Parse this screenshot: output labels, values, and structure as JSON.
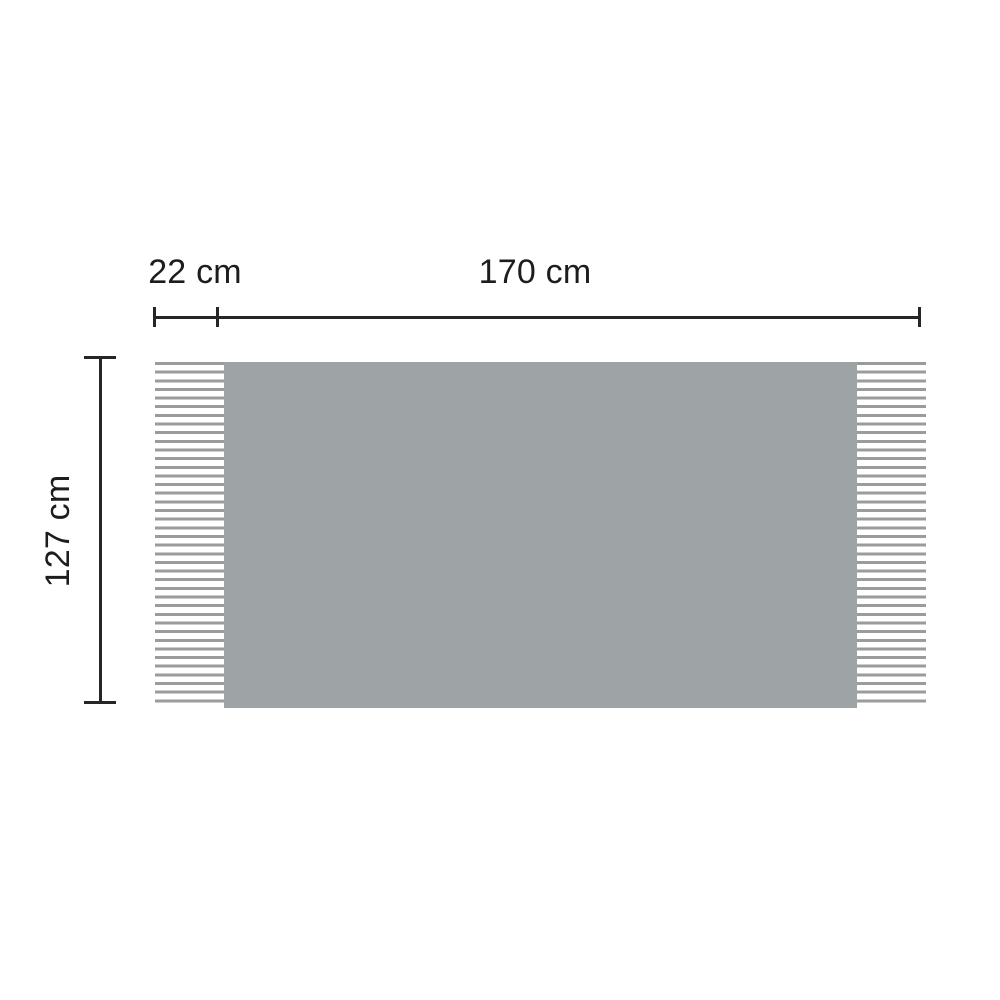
{
  "diagram": {
    "type": "product-dimension-diagram",
    "subject": "rectangular throw blanket with fringed left and right ends",
    "labels": {
      "fringe_width": "22 cm",
      "body_width": "170 cm",
      "height": "127 cm"
    },
    "colors": {
      "background": "#ffffff",
      "blanket_body": "#9ea3a6",
      "fringe_line": "#9b9b9b",
      "dimension_line": "#262626",
      "label_text": "#1d1d1d"
    }
  }
}
